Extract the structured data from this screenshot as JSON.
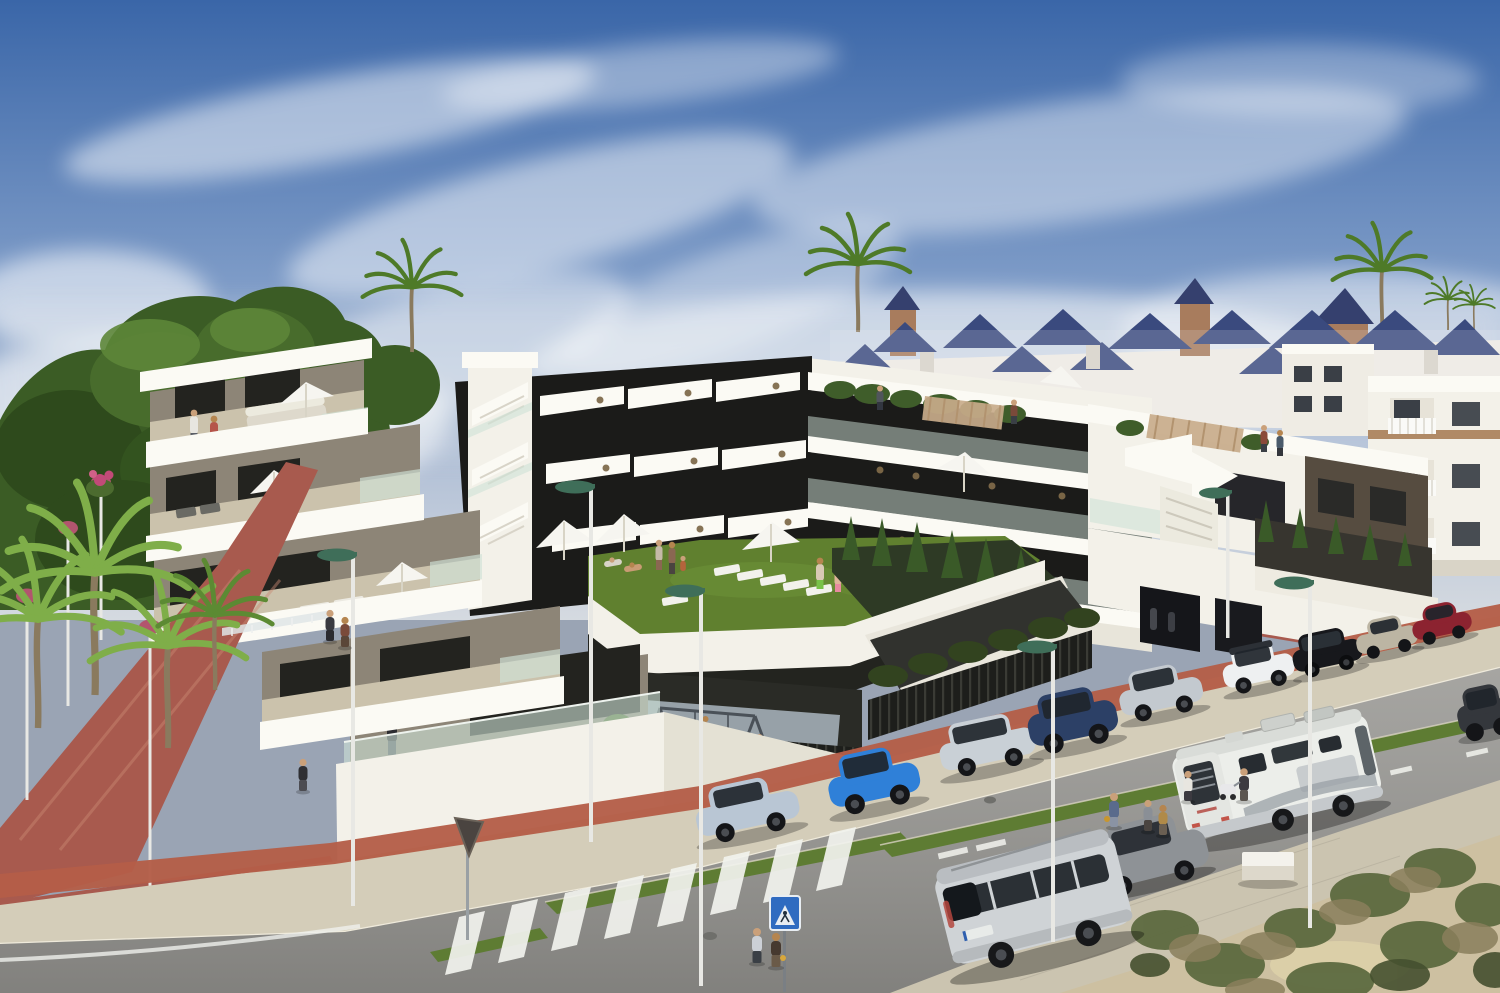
{
  "image": {
    "kind": "3d-architectural-render",
    "subject": "Modern white apartment complex with stepped diagonal balconies, roof terraces and a landscaped podium garden",
    "setting": "Coastal Spanish street with parked cars, a motorhome, palm trees, pines and villas with blue tiled roofs in the background",
    "width_px": 1500,
    "height_px": 993
  },
  "palette": {
    "sky_top": "#3a66a8",
    "sky_mid": "#7d9bc7",
    "sky_low": "#d5dae0",
    "cloud": "#ffffff",
    "pine": "#3b5c25",
    "pine_light": "#5d8638",
    "palm": "#4e7a28",
    "palm_light": "#7fae49",
    "palm_trunk": "#8a7a5e",
    "villa_wall": "#efece4",
    "villa_roof": "#3a4a7e",
    "brick": "#a87c5d",
    "white_wall": "#f3f1e9",
    "fascia": "#fbfaf4",
    "white_shade": "#e4e1d4",
    "taupe": "#8d8577",
    "glazing": "#1b1b19",
    "glass": "#cfe2d7",
    "deck": "#cbc2ac",
    "brown_band": "#564c40",
    "lawn": "#60802f",
    "hedge": "#2e3a25",
    "cypress": "#3a5a28",
    "road": "#9a9995",
    "sidewalk": "#d4cdb9",
    "bike_lane": "#b45e48",
    "brick_path": "#a85a4e",
    "median": "#5e7c33",
    "sand": "#cdc0a1",
    "concrete": "#cbc4b0",
    "fence": "#1d1e1b",
    "play_floor": "#97a1a8",
    "lamp_pole": "#e8e8e4",
    "lamp_green": "#3f6e59",
    "lamp_pink": "#b2556e",
    "marking": "#f2f3ee",
    "sign_blue": "#2f6bc0",
    "bench": "#f4f2ec",
    "scrub": "#5d6a40",
    "scrub_dry": "#8a7f5c"
  },
  "scene": {
    "sky": {
      "description": "Blue sky with wispy white cirrus clouds and haze near the horizon"
    },
    "background": {
      "villas": "rows of white villas with dark-blue pyramid tile roofs and round brick towers",
      "apartments": "white holiday apartment blocks with white balustrade balconies",
      "tall_palms": 3
    },
    "complex": {
      "left_block": {
        "levels": 4,
        "style": "stepped terraces, taupe walls, white parapets, glass balustrades",
        "details": [
          "white parasols",
          "terrace sofa",
          "sun loungers",
          "residents on terraces"
        ]
      },
      "center_block": {
        "style": "black glazing bands crossed by white diagonal balcony fins",
        "roof": "white slab with roof garden planting and pergola seating"
      },
      "right_block": {
        "style": "white volume with dark-brown upper band",
        "details": [
          "roof terrace with pergola",
          "white zig-zag exterior stair and arrow-shaped flight",
          "street-level garage openings"
        ]
      },
      "stair_tower": "white stair core with exposed flights between blocks",
      "podium_garden": {
        "lawn_loungers": 6,
        "parasols": 3,
        "sunbathers": 4,
        "cypresses": 6
      },
      "playground": {
        "swing_frames": 2,
        "children": 3,
        "enclosure": "black slatted fence"
      }
    },
    "street": {
      "surfaces": [
        "grey asphalt roadway",
        "beige paved sidewalk",
        "terracotta bike lane",
        "red brick pedestrian ramp",
        "artificial-grass medians",
        "sandy scrub verge"
      ],
      "crosswalk_stripes": 8,
      "lamps_green_head": 6,
      "lamps_pink_head": 4,
      "signs": [
        {
          "name": "pedestrian-crossing-sign",
          "shape": "blue square with white triangle"
        },
        {
          "name": "yield-sign",
          "note": "seen from behind"
        }
      ],
      "street_furniture": [
        "white concrete bench",
        "manhole covers"
      ]
    },
    "vehicles": [
      {
        "id": "peugeot-106",
        "label": "light-blue hatchback",
        "color": "#b9c6d4"
      },
      {
        "id": "matiz",
        "label": "bright blue city car",
        "color": "#2f80d8"
      },
      {
        "id": "fabia-wagon",
        "label": "silver estate",
        "color": "#c9d0d6"
      },
      {
        "id": "ateca",
        "label": "navy SUV",
        "color": "#2c4066"
      },
      {
        "id": "i20",
        "label": "silver hatchback",
        "color": "#c3c9cf"
      },
      {
        "id": "c3",
        "label": "white crossover with dark roof",
        "color": "#eef0f1"
      },
      {
        "id": "estate-black",
        "label": "black estate",
        "color": "#17181c"
      },
      {
        "id": "coupe",
        "label": "champagne coupe",
        "color": "#bcb5a3"
      },
      {
        "id": "model3",
        "label": "dark red saloon",
        "color": "#8c2330"
      },
      {
        "id": "edge-car",
        "label": "dark grey car at right edge",
        "color": "#34373c"
      },
      {
        "id": "van",
        "label": "silver MPV van",
        "color": "#cfd3d6"
      },
      {
        "id": "grey-sedan",
        "label": "grey hatchback",
        "color": "#8e9296"
      },
      {
        "id": "motorhome",
        "label": "white RV motorhome",
        "color": "#eceeea"
      }
    ],
    "people": {
      "on_sidewalk": 8,
      "on_path": 3,
      "on_terraces": 8,
      "in_courtyard": 9,
      "in_playground": 3
    }
  }
}
